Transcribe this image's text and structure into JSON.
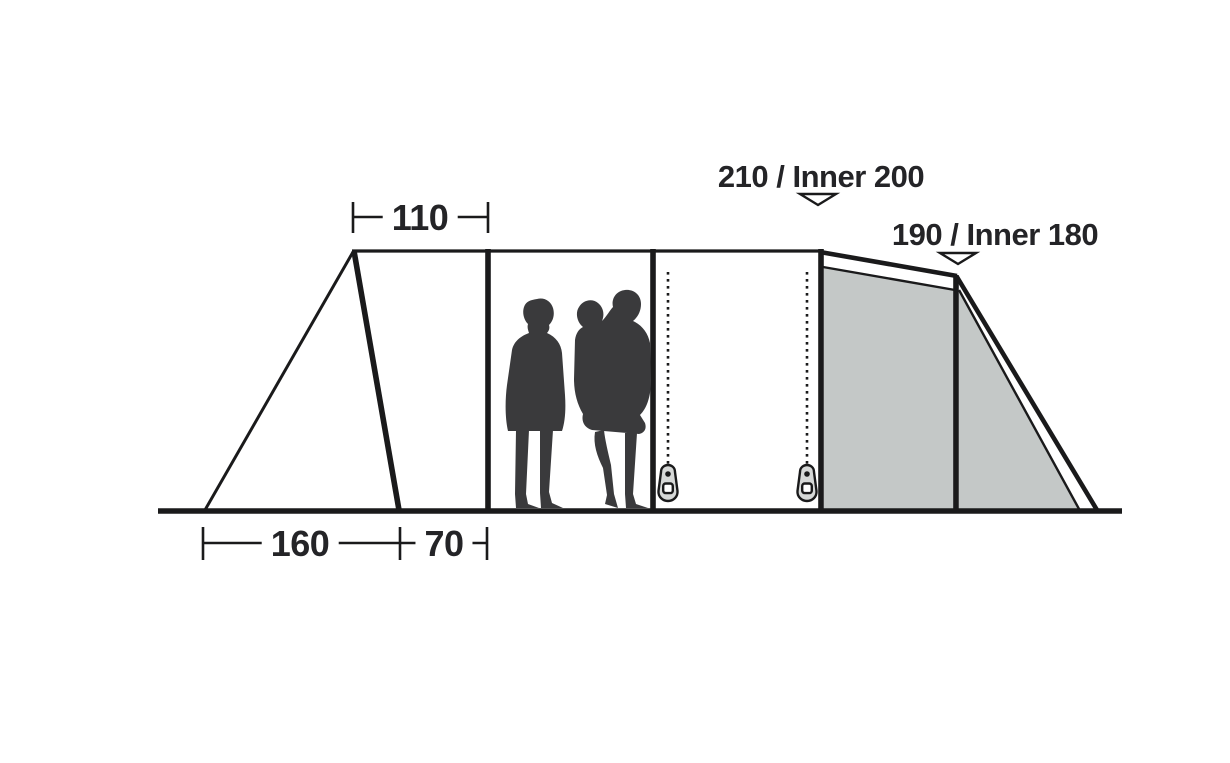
{
  "diagram": {
    "kind": "tent-side-profile-dimension-diagram",
    "dimension_labels": {
      "top_width": "110",
      "bottom_left_length": "160",
      "bottom_right_length": "70"
    },
    "height_labels": {
      "main_peak": "210 / Inner 200",
      "rear_peak": "190 / Inner 180"
    },
    "colors": {
      "line": "#1a1a1b",
      "text": "#242427",
      "panel_fill": "#c4c8c7",
      "silhouette": "#3a3a3c",
      "zipper_pull_fill": "#d6d8d7",
      "background": "#ffffff"
    },
    "icons": {
      "height_marker": "triangle-down-marker-icon",
      "zipper_pull": "zipper-pull-icon",
      "people": "people-silhouette"
    }
  }
}
